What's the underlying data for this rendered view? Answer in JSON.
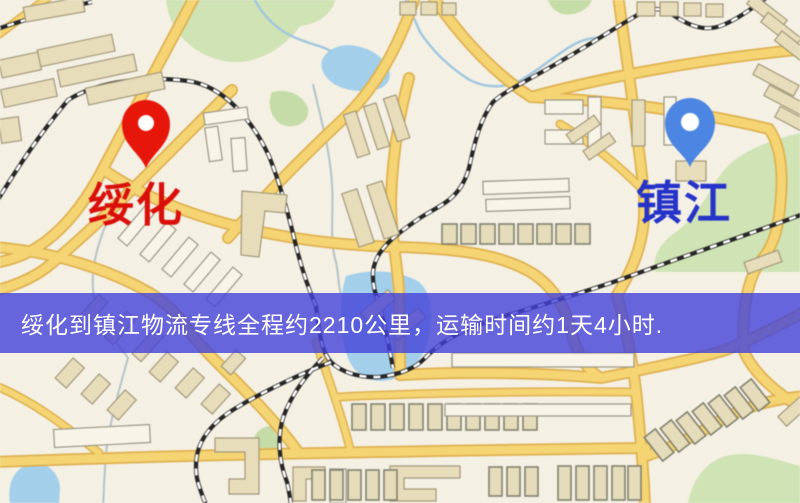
{
  "window": {
    "width": 800,
    "height": 503
  },
  "map": {
    "kind": "logistics-route-map",
    "origin_marker": {
      "city": "绥化",
      "pin_color": "#ee1408",
      "label_color": "#e10d08"
    },
    "destination_marker": {
      "city": "镇江",
      "pin_color": "#4a86e6",
      "label_color": "#2433cf"
    },
    "banner": {
      "text": "绥化到镇江物流专线全程约2210公里，运输时间约1天4小时.",
      "background": "#4442da",
      "opacity": 0.8,
      "text_color": "#ffffff"
    },
    "route": {
      "distance_km": 2210,
      "duration": "1天4小时"
    }
  }
}
